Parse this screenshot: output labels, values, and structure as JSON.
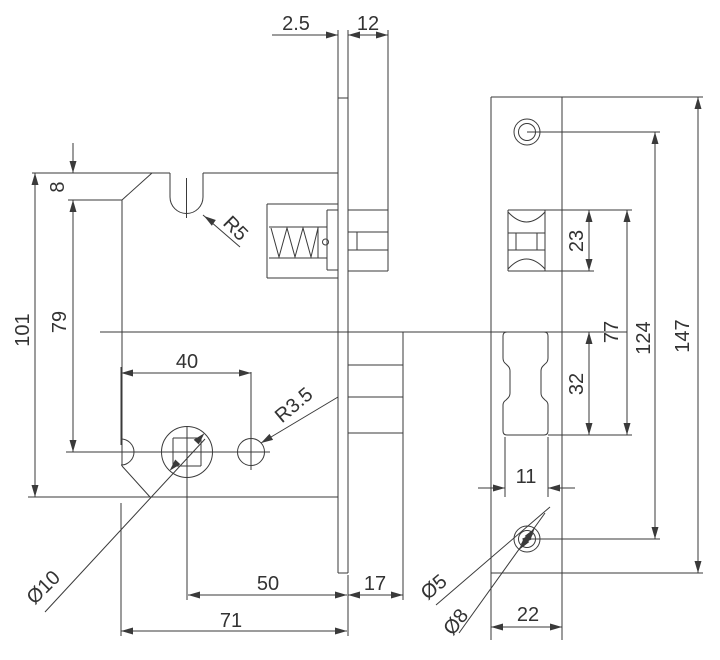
{
  "page": {
    "description": "Technical engineering drawing of a mortise roller lock body and faceplate with dimensions",
    "background": "#ffffff",
    "ink": "#3a3a3a",
    "width": 720,
    "height": 660
  },
  "dimension_labels": [
    {
      "id": "dim-2-5",
      "text": "2.5",
      "x": 296,
      "y": 30,
      "rot": 0
    },
    {
      "id": "dim-12",
      "text": "12",
      "x": 368,
      "y": 30,
      "rot": 0
    },
    {
      "id": "dim-8",
      "text": "8",
      "x": 64,
      "y": 187,
      "rot": -90
    },
    {
      "id": "dim-79",
      "text": "79",
      "x": 66,
      "y": 322,
      "rot": -90
    },
    {
      "id": "dim-101",
      "text": "101",
      "x": 29,
      "y": 330,
      "rot": -90
    },
    {
      "id": "dim-40",
      "text": "40",
      "x": 187,
      "y": 368,
      "rot": 0
    },
    {
      "id": "dim-r5",
      "text": "R5",
      "x": 231,
      "y": 233,
      "rot": 45
    },
    {
      "id": "dim-r3-5",
      "text": "R3.5",
      "x": 298,
      "y": 410,
      "rot": -40
    },
    {
      "id": "dim-d10",
      "text": "Ø10",
      "x": 48,
      "y": 592,
      "rot": -45
    },
    {
      "id": "dim-50",
      "text": "50",
      "x": 268,
      "y": 590,
      "rot": 0
    },
    {
      "id": "dim-17",
      "text": "17",
      "x": 375,
      "y": 590,
      "rot": 0
    },
    {
      "id": "dim-71",
      "text": "71",
      "x": 231,
      "y": 627,
      "rot": 0
    },
    {
      "id": "dim-23",
      "text": "23",
      "x": 583,
      "y": 241,
      "rot": -90
    },
    {
      "id": "dim-32",
      "text": "32",
      "x": 583,
      "y": 384,
      "rot": -90
    },
    {
      "id": "dim-77",
      "text": "77",
      "x": 618,
      "y": 332,
      "rot": -90
    },
    {
      "id": "dim-124",
      "text": "124",
      "x": 650,
      "y": 338,
      "rot": -90
    },
    {
      "id": "dim-147",
      "text": "147",
      "x": 689,
      "y": 336,
      "rot": -90
    },
    {
      "id": "dim-11",
      "text": "11",
      "x": 526,
      "y": 483,
      "rot": 0
    },
    {
      "id": "dim-22",
      "text": "22",
      "x": 528,
      "y": 621,
      "rot": 0
    },
    {
      "id": "dim-d5",
      "text": "Ø5",
      "x": 438,
      "y": 592,
      "rot": -40
    },
    {
      "id": "dim-d8",
      "text": "Ø8",
      "x": 461,
      "y": 626,
      "rot": -52
    }
  ],
  "geometry": {
    "lines": [
      [
        32,
        173,
        170,
        173
      ],
      [
        203,
        173,
        338,
        173
      ],
      [
        170,
        173,
        170,
        197
      ],
      [
        203,
        173,
        203,
        197
      ],
      [
        122,
        200,
        152,
        173
      ],
      [
        122,
        200,
        122,
        466
      ],
      [
        122,
        466,
        150,
        497
      ],
      [
        28,
        497,
        338,
        497
      ],
      [
        68,
        200,
        122,
        200
      ],
      [
        66,
        452,
        270,
        452
      ],
      [
        187,
        426,
        187,
        600
      ],
      [
        251,
        372,
        251,
        470
      ],
      [
        186.5,
        178,
        186.5,
        218
      ],
      [
        173,
        438,
        201,
        438
      ],
      [
        201,
        438,
        201,
        466
      ],
      [
        173,
        466,
        201,
        466
      ],
      [
        173,
        438,
        173,
        466
      ],
      [
        267,
        204,
        338,
        204
      ],
      [
        267,
        204,
        267,
        278
      ],
      [
        267,
        278,
        338,
        278
      ],
      [
        269,
        227,
        327,
        227
      ],
      [
        269,
        258,
        327,
        258
      ],
      [
        318,
        227,
        318,
        258
      ],
      [
        327,
        210,
        327,
        270
      ],
      [
        327,
        210,
        338,
        210
      ],
      [
        327,
        270,
        338,
        270
      ],
      [
        338,
        30,
        338,
        573
      ],
      [
        348,
        30,
        348,
        573
      ],
      [
        338,
        98,
        348,
        98
      ],
      [
        338,
        573,
        348,
        573
      ],
      [
        388,
        30,
        388,
        210
      ],
      [
        348,
        210,
        388,
        210
      ],
      [
        348,
        271,
        388,
        271
      ],
      [
        388,
        210,
        388,
        271
      ],
      [
        348,
        232,
        388,
        232
      ],
      [
        348,
        250,
        388,
        250
      ],
      [
        357,
        232,
        357,
        250
      ],
      [
        403,
        332,
        403,
        433
      ],
      [
        348,
        433,
        403,
        433
      ],
      [
        348,
        365,
        403,
        365
      ],
      [
        348,
        397,
        403,
        397
      ],
      [
        100,
        332,
        627,
        332
      ],
      [
        403,
        433,
        403,
        600
      ],
      [
        348,
        575,
        348,
        636
      ],
      [
        491,
        97,
        703,
        97
      ],
      [
        491,
        97,
        491,
        640
      ],
      [
        562,
        97,
        562,
        640
      ],
      [
        491,
        573,
        703,
        573
      ],
      [
        527,
        132,
        660,
        132
      ],
      [
        527,
        539,
        660,
        539
      ],
      [
        508,
        210,
        545,
        210
      ],
      [
        508,
        210,
        508,
        271
      ],
      [
        545,
        210,
        545,
        271
      ],
      [
        508,
        233,
        545,
        233
      ],
      [
        508,
        250,
        545,
        250
      ],
      [
        516,
        233,
        516,
        250
      ],
      [
        537,
        233,
        537,
        250
      ],
      [
        508,
        271,
        545,
        271
      ],
      [
        545,
        210,
        632,
        210
      ],
      [
        545,
        271,
        594,
        271
      ],
      [
        548,
        435,
        632,
        435
      ],
      [
        505,
        437,
        505,
        497
      ],
      [
        548,
        437,
        548,
        497
      ],
      [
        272,
        35,
        338,
        35
      ],
      [
        348,
        35,
        388,
        35
      ],
      [
        35,
        173,
        35,
        497
      ],
      [
        73,
        143,
        73,
        173
      ],
      [
        73,
        200,
        73,
        452
      ],
      [
        121,
        373,
        251,
        373
      ],
      [
        121,
        367,
        121,
        445
      ],
      [
        121,
        503,
        121,
        636
      ],
      [
        188,
        595,
        347,
        595
      ],
      [
        348,
        595,
        403,
        595
      ],
      [
        121,
        631,
        347,
        631
      ],
      [
        589,
        210,
        589,
        271
      ],
      [
        589,
        332,
        589,
        435
      ],
      [
        627,
        210,
        627,
        435
      ],
      [
        655,
        132,
        655,
        539
      ],
      [
        698,
        97,
        698,
        573
      ],
      [
        478,
        488,
        505,
        488
      ],
      [
        548,
        488,
        575,
        488
      ],
      [
        491,
        627,
        562,
        627
      ],
      [
        45,
        612,
        205,
        439
      ],
      [
        338,
        397,
        261,
        443
      ],
      [
        240,
        247,
        203,
        215
      ],
      [
        436,
        605,
        550,
        507
      ],
      [
        459,
        633,
        545,
        513
      ]
    ],
    "circles": [
      [
        187,
        452,
        25.5
      ],
      [
        251,
        452,
        13.5
      ],
      [
        325.5,
        242,
        3
      ],
      [
        527,
        132,
        13
      ],
      [
        527,
        132,
        8.5
      ],
      [
        527,
        539,
        13
      ],
      [
        527,
        539,
        8.5
      ]
    ],
    "paths": [
      "M170,197 A16.5,16.5 0 0 0 203,197",
      "M121,439 A13,13 0 0 1 121,465",
      "M271,228 L279,257 L287,228 L295,257 L303,228 L311,257 L318,228",
      "M508,212 Q526.5,232 545,212",
      "M508,269 Q526.5,249 545,269",
      "M507,332 H544 Q548,332 548,336 V358 Q548,362 545,364 L543,366 Q541,368 541,371 V393 Q541,396 543,398 L545,400 Q548,402 548,405 V431 Q548,435 544,435 H507 Q503,435 503,431 V405 Q503,402 506,400 L508,398 Q510,396 510,393 V371 Q510,368 508,366 L506,364 Q503,362 503,358 V336 Q503,332 507,332 Z"
    ],
    "arrows": [
      [
        338,
        35,
        0
      ],
      [
        348,
        35,
        180
      ],
      [
        388,
        35,
        0
      ],
      [
        73,
        173,
        90
      ],
      [
        73,
        200,
        270
      ],
      [
        73,
        452,
        90
      ],
      [
        35,
        173,
        270
      ],
      [
        35,
        497,
        90
      ],
      [
        121,
        373,
        180
      ],
      [
        251,
        373,
        0
      ],
      [
        188,
        595,
        180
      ],
      [
        347,
        595,
        0
      ],
      [
        348,
        595,
        180
      ],
      [
        403,
        595,
        0
      ],
      [
        121,
        631,
        180
      ],
      [
        347,
        631,
        0
      ],
      [
        169.6,
        470.7,
        133
      ],
      [
        204.4,
        433.3,
        -47
      ],
      [
        261,
        443,
        149
      ],
      [
        204,
        216,
        215
      ],
      [
        589,
        210,
        270
      ],
      [
        589,
        271,
        90
      ],
      [
        589,
        332,
        270
      ],
      [
        589,
        435,
        90
      ],
      [
        627,
        210,
        270
      ],
      [
        627,
        435,
        90
      ],
      [
        655,
        132,
        270
      ],
      [
        655,
        539,
        90
      ],
      [
        698,
        97,
        270
      ],
      [
        698,
        573,
        90
      ],
      [
        505,
        488,
        0
      ],
      [
        548,
        488,
        180
      ],
      [
        491,
        627,
        180
      ],
      [
        562,
        627,
        0
      ],
      [
        533.4,
        533.5,
        -41
      ],
      [
        520.6,
        544.5,
        139
      ],
      [
        534.6,
        528.4,
        -54
      ],
      [
        519.4,
        549.6,
        126
      ]
    ]
  }
}
